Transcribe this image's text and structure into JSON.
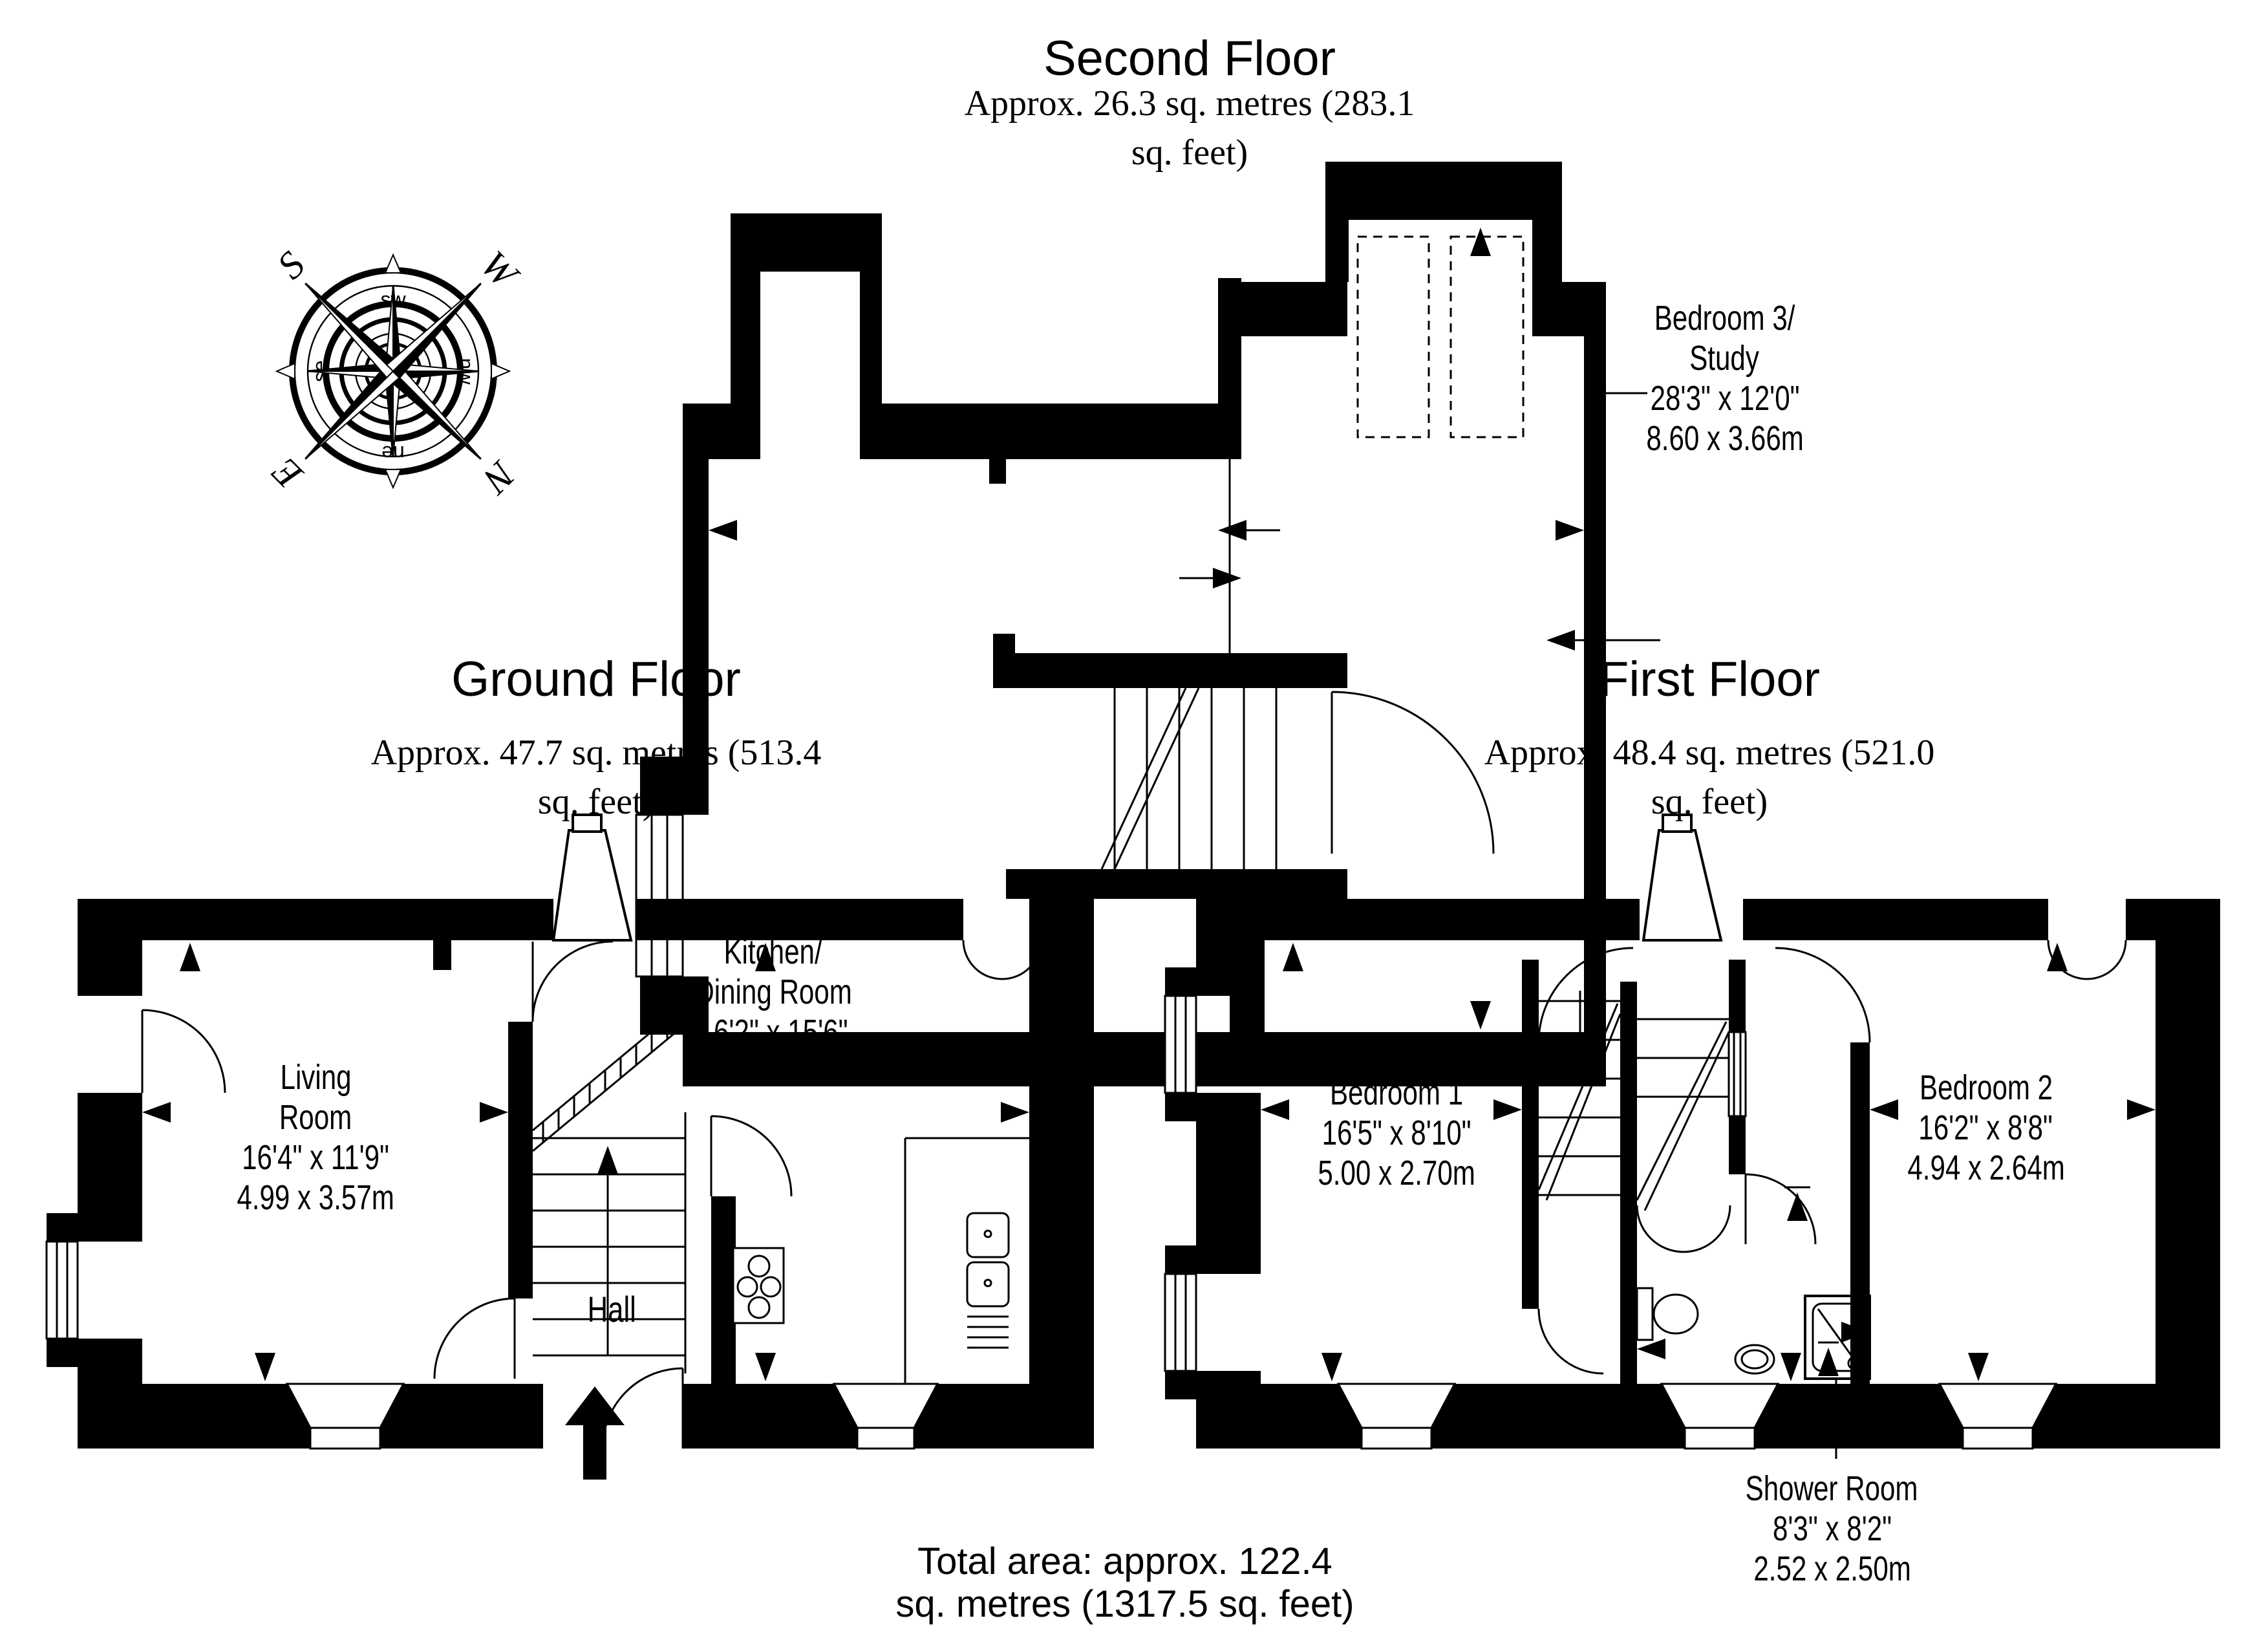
{
  "floors": {
    "second": {
      "title": "Second Floor",
      "area": "Approx. 26.3 sq. metres (283.1 sq. feet)"
    },
    "ground": {
      "title": "Ground Floor",
      "area": "Approx. 47.7 sq. metres (513.4 sq. feet)"
    },
    "first": {
      "title": "First Floor",
      "area": "Approx. 48.4 sq. metres (521.0 sq. feet)"
    }
  },
  "rooms": {
    "bedroom3": {
      "name_line1": "Bedroom 3/",
      "name_line2": "Study",
      "imperial": "28'3\" x 12'0\"",
      "metric": "8.60 x 3.66m"
    },
    "living": {
      "name_line1": "Living",
      "name_line2": "Room",
      "imperial": "16'4\" x 11'9\"",
      "metric": "4.99 x 3.57m"
    },
    "kitchen": {
      "name_line1": "Kitchen/",
      "name_line2": "Dining Room",
      "imperial": "16'2\" x 15'6\"",
      "metric": "4.93 x 4.73m"
    },
    "hall": {
      "name": "Hall"
    },
    "bedroom1": {
      "name": "Bedroom 1",
      "imperial": "16'5\" x 8'10\"",
      "metric": "5.00 x 2.70m"
    },
    "bedroom2": {
      "name": "Bedroom 2",
      "imperial": "16'2\" x 8'8\"",
      "metric": "4.94 x 2.64m"
    },
    "shower": {
      "name": "Shower Room",
      "imperial": "8'3\" x 8'2\"",
      "metric": "2.52 x 2.50m"
    }
  },
  "total_area": "Total area: approx. 122.4 sq. metres (1317.5 sq. feet)",
  "compass": {
    "n": "N",
    "e": "E",
    "s": "S",
    "w": "W",
    "ne": "ne",
    "nw": "nw",
    "se": "se",
    "sw": "sw"
  },
  "colors": {
    "ink": "#000000",
    "paper": "#ffffff"
  }
}
